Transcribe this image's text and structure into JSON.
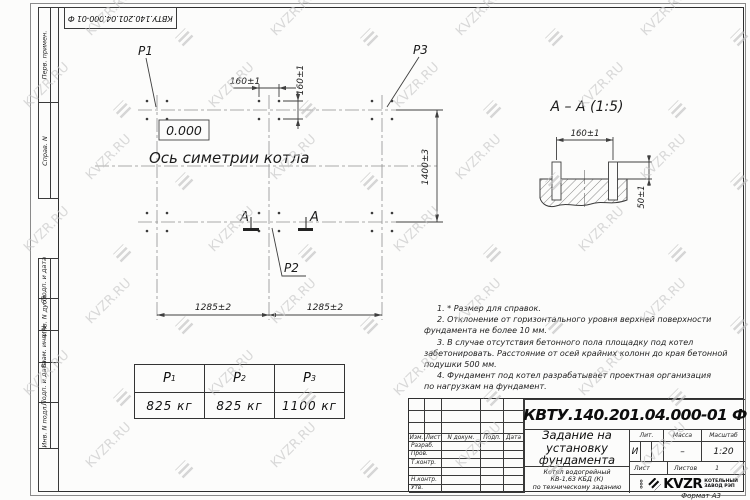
{
  "sheet": {
    "format_label": "Формат А3"
  },
  "watermark": {
    "text": "KVZR.RU"
  },
  "top_stamp": {
    "text": "КВТУ.140.201.04.000-01 Ф"
  },
  "margin_labels": {
    "top": [
      "Перв. примен.",
      "Справ. N"
    ],
    "bottom": [
      "Подп. и дата",
      "Инв. N дубл.",
      "Взам. инв. N",
      "Подп. и дата",
      "Инв. N подл."
    ]
  },
  "plan": {
    "load_labels": {
      "p1": "P1",
      "p2": "P2",
      "p3": "P3"
    },
    "elevation_mark": "0.000",
    "axis_caption": "Ось симетрии котла",
    "section_letter_left": "А",
    "section_letter_right": "А",
    "dim_bolt_horizontal": "160±1",
    "dim_bolt_vertical": "160±1",
    "dim_width": "1400±3",
    "dim_span_left": "1285±2",
    "dim_span_right": "1285±2"
  },
  "section_view": {
    "title": "А – А (1:5)",
    "dim_bolt_spacing": "160±1",
    "dim_bolt_height": "50±1"
  },
  "notes": [
    {
      "indent": true,
      "text": "1. * Размер для справок."
    },
    {
      "indent": true,
      "text": "2. Отклонение от горизонтального уровня верхней поверхности"
    },
    {
      "indent": false,
      "text": "фундамента не более 10 мм."
    },
    {
      "indent": true,
      "text": "3. В случае отсутствия бетонного пола площадку под котел"
    },
    {
      "indent": false,
      "text": "забетонировать. Расстояние от осей крайних колонн до края бетонной"
    },
    {
      "indent": false,
      "text": "подушки 500 мм."
    },
    {
      "indent": true,
      "text": "4. Фундамент под котел разрабатывает проектная организация"
    },
    {
      "indent": false,
      "text": "по нагрузкам на фундамент."
    }
  ],
  "load_table": {
    "columns": [
      {
        "label": "P",
        "sub": "1",
        "value": "825 кг"
      },
      {
        "label": "P",
        "sub": "2",
        "value": "825 кг"
      },
      {
        "label": "P",
        "sub": "3",
        "value": "1100 кг"
      }
    ]
  },
  "title_block": {
    "doc_number": "КВТУ.140.201.04.000-01 Ф",
    "title_lines": [
      "Задание на",
      "установку",
      "фундамента"
    ],
    "product_lines": [
      "Котел водогрейный",
      "КВ-1,63 КБД (К)",
      "по техническому заданию"
    ],
    "header_cells": [
      "Изм.",
      "Лист",
      "N докум.",
      "Подп.",
      "Дата"
    ],
    "roles": [
      "Разраб.",
      "Пров.",
      "Т.контр.",
      "",
      "Н.контр.",
      "Утв."
    ],
    "lit_label": "Лит.",
    "mass_label": "Масса",
    "scale_label": "Масштаб",
    "lit_value": "И",
    "mass_value": "–",
    "scale_value": "1:20",
    "sheet_label": "Лист",
    "sheets_label": "Листов",
    "sheets_value": "1",
    "company": {
      "abbr": "ООО",
      "name": "KVZR",
      "tagline1": "КОТЕЛЬНЫЙ",
      "tagline2": "ЗАВОД РЭП"
    }
  }
}
